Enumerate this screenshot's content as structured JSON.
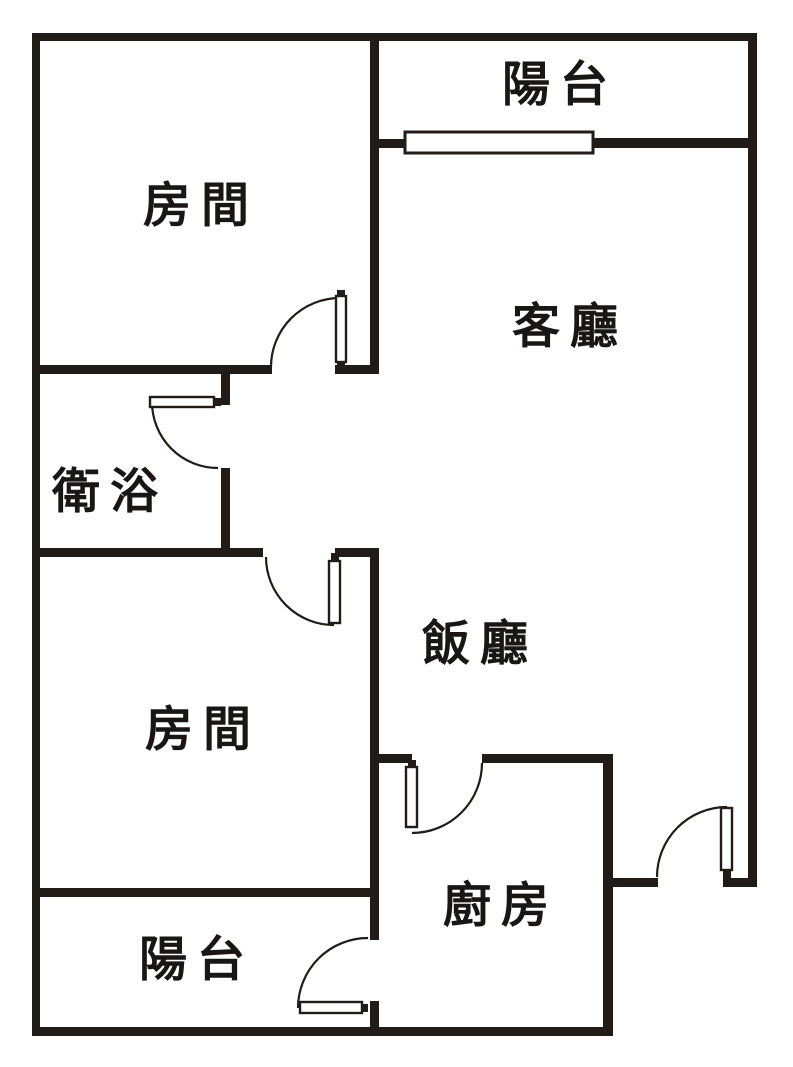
{
  "page": {
    "background": "#ffffff",
    "document_type": "apartment floor plan"
  },
  "floor_plan": {
    "canvas": {
      "width": 793,
      "height": 1067
    },
    "colors": {
      "wall": "#211c18",
      "line": "#211c18",
      "door_fill": "#ffffff",
      "window_fill": "#ffffff",
      "label": "#1a1613"
    },
    "rooms": [
      {
        "id": "balcony-top",
        "label": "陽台",
        "x": 560,
        "y": 85
      },
      {
        "id": "bedroom-1",
        "label": "房間",
        "x": 201,
        "y": 206
      },
      {
        "id": "living-room",
        "label": "客廳",
        "x": 570,
        "y": 327
      },
      {
        "id": "bathroom",
        "label": "衛浴",
        "x": 110,
        "y": 492
      },
      {
        "id": "dining-room",
        "label": "飯廳",
        "x": 480,
        "y": 644
      },
      {
        "id": "bedroom-2",
        "label": "房間",
        "x": 203,
        "y": 730
      },
      {
        "id": "kitchen",
        "label": "廚房",
        "x": 501,
        "y": 906
      },
      {
        "id": "balcony-bottom",
        "label": "陽台",
        "x": 197,
        "y": 960
      }
    ],
    "walls": [
      {
        "name": "outer-wall-left",
        "x": 32,
        "y": 33,
        "w": 8,
        "h": 1003
      },
      {
        "name": "outer-wall-top",
        "x": 32,
        "y": 33,
        "w": 725,
        "h": 8
      },
      {
        "name": "outer-wall-right",
        "x": 748,
        "y": 33,
        "w": 9,
        "h": 854
      },
      {
        "name": "outer-wall-bottom",
        "x": 32,
        "y": 1027,
        "w": 581,
        "h": 9
      },
      {
        "name": "entry-wall-left-seg",
        "x": 613,
        "y": 878,
        "w": 45,
        "h": 9
      },
      {
        "name": "entry-wall-right-seg",
        "x": 723,
        "y": 878,
        "w": 34,
        "h": 9
      },
      {
        "name": "kitchen-east-wall",
        "x": 603,
        "y": 754,
        "w": 10,
        "h": 282
      },
      {
        "name": "core-wall-upper",
        "x": 370,
        "y": 33,
        "w": 9,
        "h": 341
      },
      {
        "name": "core-wall-lower",
        "x": 370,
        "y": 548,
        "w": 9,
        "h": 392
      },
      {
        "name": "core-wall-stub",
        "x": 370,
        "y": 1001,
        "w": 9,
        "h": 35
      },
      {
        "name": "bedroom1-south-wall-left",
        "x": 32,
        "y": 365,
        "w": 240,
        "h": 9
      },
      {
        "name": "bedroom1-south-wall-right",
        "x": 335,
        "y": 365,
        "w": 44,
        "h": 9
      },
      {
        "name": "balcony-sill-left-stub",
        "x": 379,
        "y": 139,
        "w": 27,
        "h": 9
      },
      {
        "name": "balcony-sill-right",
        "x": 592,
        "y": 138,
        "w": 156,
        "h": 10
      },
      {
        "name": "bathroom-east-wall-upper",
        "x": 221,
        "y": 365,
        "w": 9,
        "h": 40
      },
      {
        "name": "bathroom-east-wall-lower",
        "x": 221,
        "y": 468,
        "w": 9,
        "h": 89
      },
      {
        "name": "bathroom-south-wall",
        "x": 32,
        "y": 548,
        "w": 231,
        "h": 9
      },
      {
        "name": "bedroom2-north-wall-right",
        "x": 335,
        "y": 548,
        "w": 44,
        "h": 9
      },
      {
        "name": "bedroom2-south-wall",
        "x": 32,
        "y": 888,
        "w": 347,
        "h": 9
      },
      {
        "name": "kitchen-north-wall-left",
        "x": 375,
        "y": 754,
        "w": 37,
        "h": 9
      },
      {
        "name": "kitchen-north-wall-right",
        "x": 482,
        "y": 754,
        "w": 131,
        "h": 9
      }
    ],
    "windows": [
      {
        "name": "balcony-window",
        "x": 405,
        "y": 132,
        "w": 188,
        "h": 21
      }
    ],
    "doors": [
      {
        "at": "bedroom-1",
        "leaf": {
          "x": 336,
          "y": 296,
          "w": 10,
          "h": 66
        },
        "arc": "M 271 367 A 69 69 0 0 1 340 298",
        "nubs": [
          {
            "x": 337,
            "y": 290,
            "w": 8,
            "h": 7
          },
          {
            "x": 337,
            "y": 360,
            "w": 8,
            "h": 6
          }
        ]
      },
      {
        "at": "bathroom",
        "leaf": {
          "x": 150,
          "y": 397,
          "w": 64,
          "h": 10
        },
        "arc": "M 152 402 A 66 66 0 0 0 218 468",
        "nubs": [
          {
            "x": 212,
            "y": 398,
            "w": 9,
            "h": 8
          }
        ]
      },
      {
        "at": "bedroom-2",
        "leaf": {
          "x": 329,
          "y": 561,
          "w": 11,
          "h": 62
        },
        "arc": "M 266 557 A 68 68 0 0 0 334 625",
        "nubs": [
          {
            "x": 331,
            "y": 553,
            "w": 8,
            "h": 9
          }
        ]
      },
      {
        "at": "kitchen",
        "leaf": {
          "x": 406,
          "y": 767,
          "w": 11,
          "h": 60
        },
        "arc": "M 482 763 A 70 70 0 0 1 412 833",
        "nubs": [
          {
            "x": 408,
            "y": 760,
            "w": 8,
            "h": 8
          }
        ]
      },
      {
        "at": "entrance",
        "leaf": {
          "x": 721,
          "y": 808,
          "w": 11,
          "h": 62
        },
        "arc": "M 657 877 A 70 70 0 0 1 727 807",
        "nubs": [
          {
            "x": 723,
            "y": 869,
            "w": 8,
            "h": 9
          }
        ]
      },
      {
        "at": "balcony-bottom",
        "leaf": {
          "x": 300,
          "y": 1002,
          "w": 62,
          "h": 11
        },
        "arc": "M 298 1008 A 70 70 0 0 1 368 938",
        "nubs": [
          {
            "x": 359,
            "y": 1004,
            "w": 9,
            "h": 8
          }
        ]
      }
    ]
  }
}
